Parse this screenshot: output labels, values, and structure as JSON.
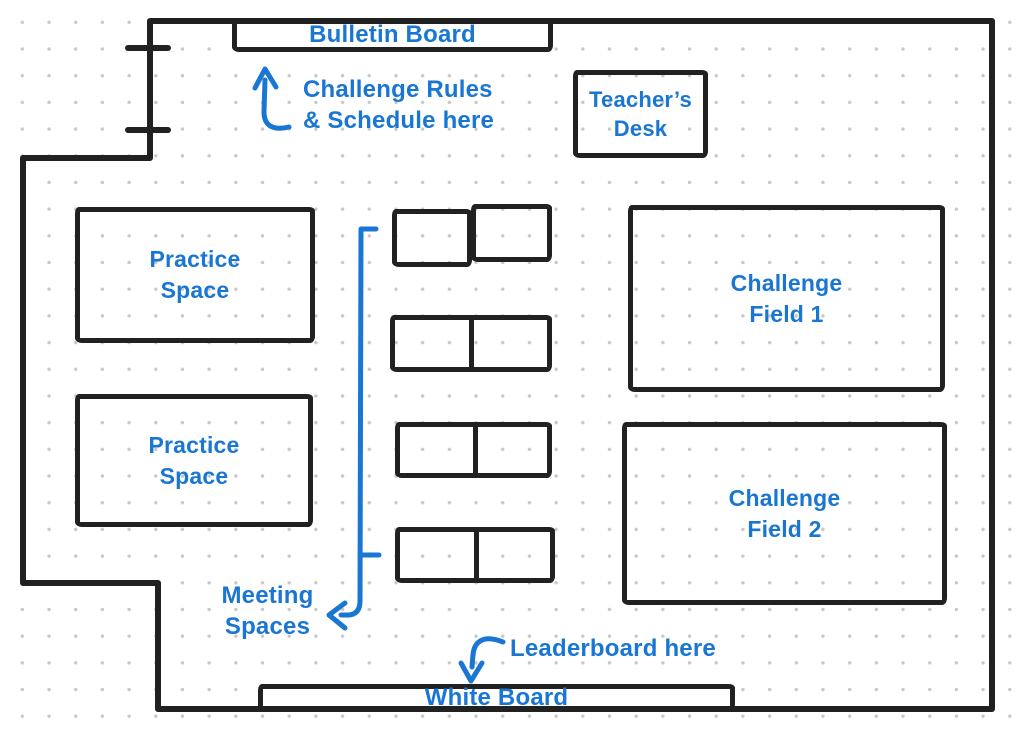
{
  "title": "Classroom challenge floor plan",
  "colors": {
    "ink": "#212121",
    "annotation_blue": "#1976d2",
    "dot_grid": "#c8c8c8",
    "background": "#ffffff"
  },
  "fixtures": {
    "bulletin_board": "Bulletin Board",
    "teachers_desk": "Teacher’s\nDesk",
    "practice_space_1": "Practice\nSpace",
    "practice_space_2": "Practice\nSpace",
    "challenge_field_1": "Challenge\nField 1",
    "challenge_field_2": "Challenge\nField 2",
    "white_board": "White Board"
  },
  "annotations": {
    "rules_note": "Challenge Rules\n& Schedule here",
    "meeting_spaces": "Meeting\nSpaces",
    "leaderboard_note": "Leaderboard here"
  }
}
